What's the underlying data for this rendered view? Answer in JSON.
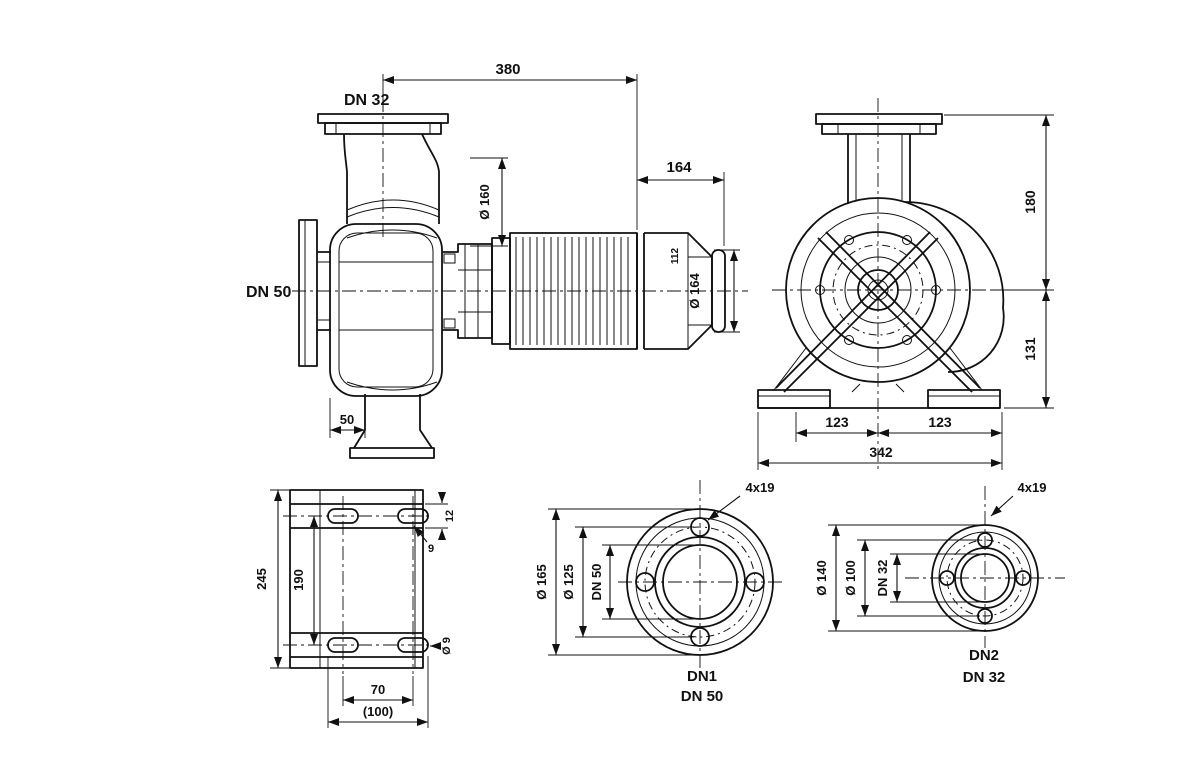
{
  "colors": {
    "line": "#111111",
    "background": "#ffffff"
  },
  "side_view": {
    "discharge_label": "DN 32",
    "suction_label": "DN 50",
    "overall_length": "380",
    "motor_length": "164",
    "adapter_diameter": "Ø 160",
    "motor_detail": "112",
    "motor_diameter": "Ø 164",
    "foot_offset": "50"
  },
  "front_view": {
    "height_above_axis": "180",
    "height_below_axis": "131",
    "foot_span_left": "123",
    "foot_span_right": "123",
    "overall_width": "342"
  },
  "foot_plan": {
    "overall_length": "245",
    "slot_row_spacing": "190",
    "slot_height": "12",
    "slot_width": "9",
    "hole_diameter": "Ø 9",
    "bolt_spacing": "70",
    "overall_width": "(100)"
  },
  "suction_flange": {
    "bolt_holes": "4x19",
    "outer_diameter": "Ø 165",
    "bolt_circle": "Ø 125",
    "nominal": "DN 50",
    "port_label": "DN1",
    "port_size": "DN 50"
  },
  "discharge_flange": {
    "bolt_holes": "4x19",
    "outer_diameter": "Ø 140",
    "bolt_circle": "Ø 100",
    "nominal": "DN 32",
    "port_label": "DN2",
    "port_size": "DN 32"
  }
}
